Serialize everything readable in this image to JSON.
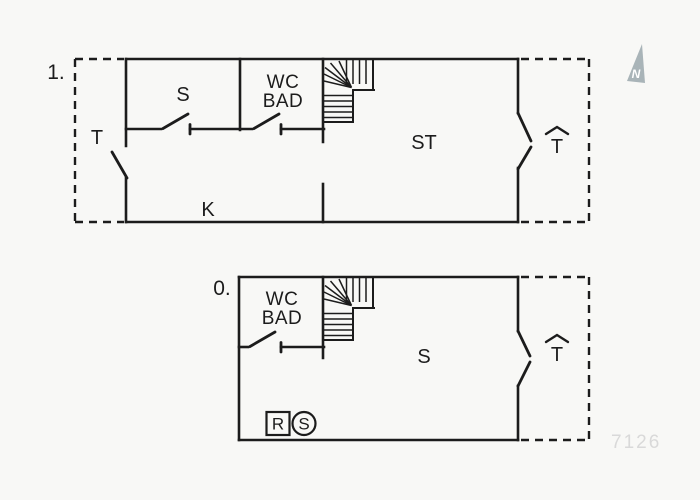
{
  "colors": {
    "background": "#f8f8f6",
    "line": "#1c1c1c",
    "compass": "#a9b4b8",
    "watermark": "#d9d9d9"
  },
  "floors": {
    "first": {
      "label": "1.",
      "entrance_label": "T",
      "room_s": "S",
      "wc_line1": "WC",
      "wc_line2": "BAD",
      "room_st": "ST",
      "room_k": "K",
      "terrace_symbol": "T"
    },
    "ground": {
      "label": "0.",
      "wc_line1": "WC",
      "wc_line2": "BAD",
      "room_s": "S",
      "badge_r": "R",
      "badge_s": "S",
      "terrace_symbol": "T"
    }
  },
  "compass": {
    "label": "N",
    "color": "#a9b4b8"
  },
  "watermark": {
    "text": "7126",
    "color": "#d9d9d9"
  }
}
